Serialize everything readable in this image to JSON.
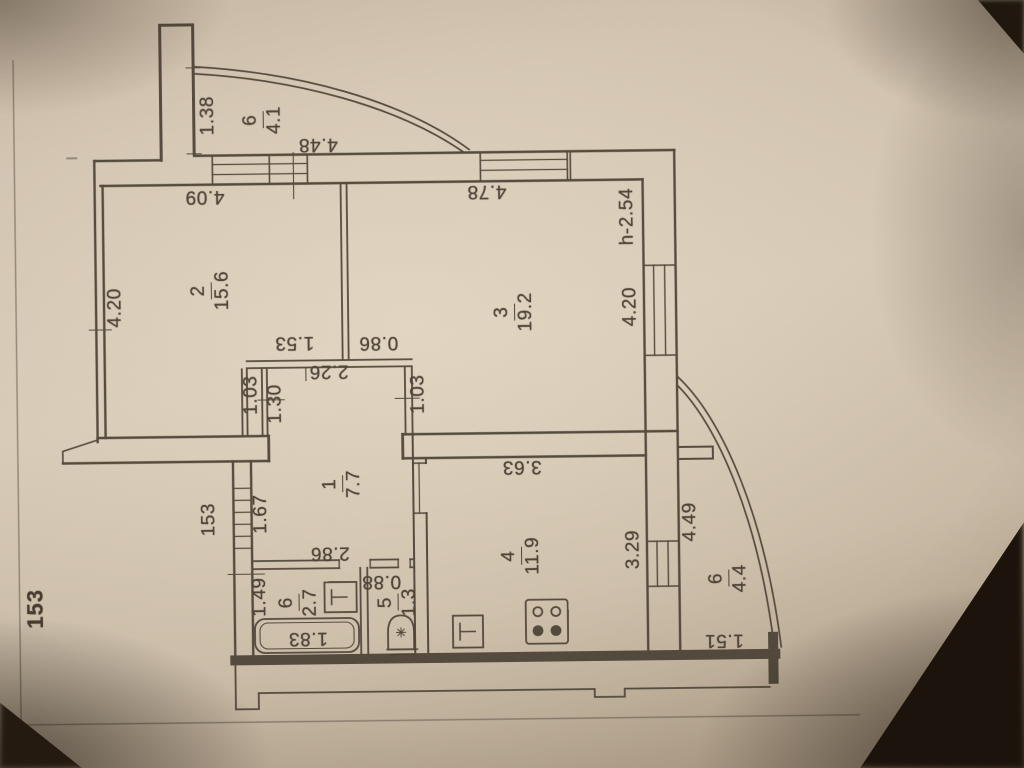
{
  "page": {
    "number": "153"
  },
  "labels": {
    "dims": {
      "balcony_top_width": "1.38",
      "balcony_top_opening": "4.48",
      "room2_top_width": "4.09",
      "room3_top_width": "4.78",
      "ceiling_height": "h-2.54",
      "room2_left_depth": "4.20",
      "room3_right_depth": "4.20",
      "hall_top_left": "1.53",
      "hall_top_right": "0.86",
      "hall_top_width": "2.26",
      "hall_door_left_a": "1.03",
      "hall_door_left_b": "1.30",
      "hall_door_right": "1.03",
      "entrance_window": "153",
      "entrance_opening": "1.67",
      "hall_bottom_width": "2.86",
      "bath_left_height": "1.49",
      "bathtub_length": "1.83",
      "wc_width": "0.88",
      "kitchen_top_width": "3.63",
      "kitchen_right_depth": "3.29",
      "balcony_right_depth": "4.49",
      "balcony_right_bottom_width": "1.51"
    },
    "rooms": {
      "hall": {
        "num": "1",
        "area": "7.7"
      },
      "room2": {
        "num": "2",
        "area": "15.6"
      },
      "room3": {
        "num": "3",
        "area": "19.2"
      },
      "kitchen": {
        "num": "4",
        "area": "11.9"
      },
      "wc": {
        "num": "5",
        "area": "1.3"
      },
      "bath": {
        "num": "6",
        "area": "2.7"
      },
      "balcony_top": {
        "num": "6",
        "area": "4.1"
      },
      "balcony_right": {
        "num": "6",
        "area": "4.4"
      }
    }
  }
}
